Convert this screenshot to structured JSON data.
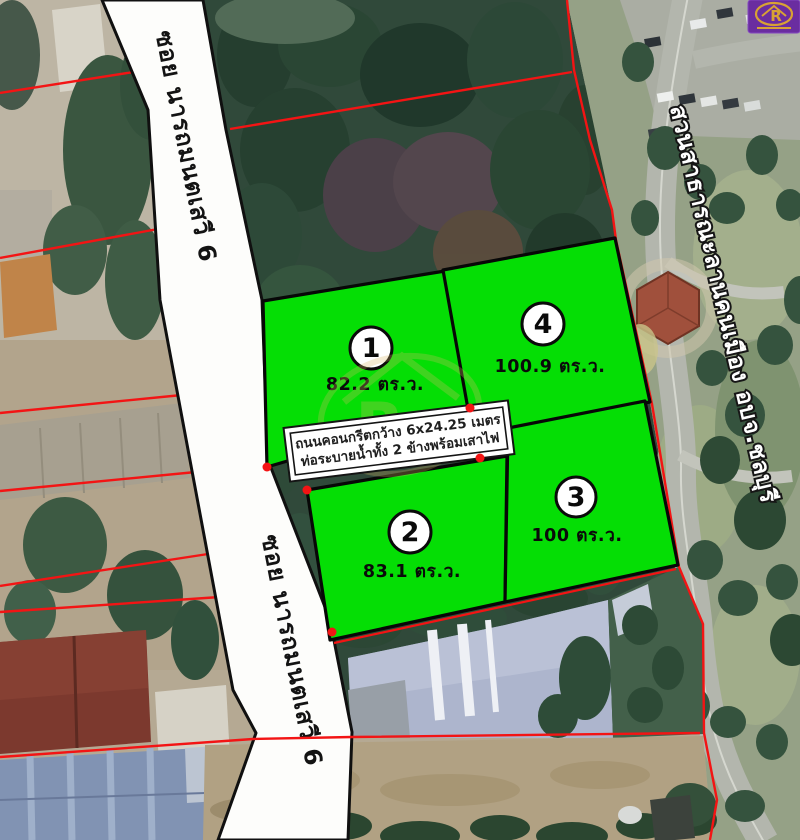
{
  "road": {
    "name": "ซอย นารถมนตเสวี 6"
  },
  "park": {
    "name": "สวนสาธารณะลานคนเมือง อบจ.ชลบุรี"
  },
  "info_box": {
    "line1": "ถนนคอนกรีตกว้าง 6x24.25 เมตร",
    "line2": "ท่อระบายน้ำทั้ง 2 ข้างพร้อมเสาไฟ"
  },
  "plots": [
    {
      "number": "1",
      "area": "82.2 ตร.ว."
    },
    {
      "number": "2",
      "area": "83.1 ตร.ว."
    },
    {
      "number": "3",
      "area": "100 ตร.ว."
    },
    {
      "number": "4",
      "area": "100.9 ตร.ว."
    }
  ],
  "logo": {
    "letter": "R"
  },
  "watermark": {
    "letter": "R"
  },
  "colors": {
    "plot_green": "#05DE05",
    "boundary_red": "#F31414",
    "road_white": "#FDFDFB",
    "logo_purple": "#6A2DA0",
    "logo_gold": "#D8A234"
  }
}
